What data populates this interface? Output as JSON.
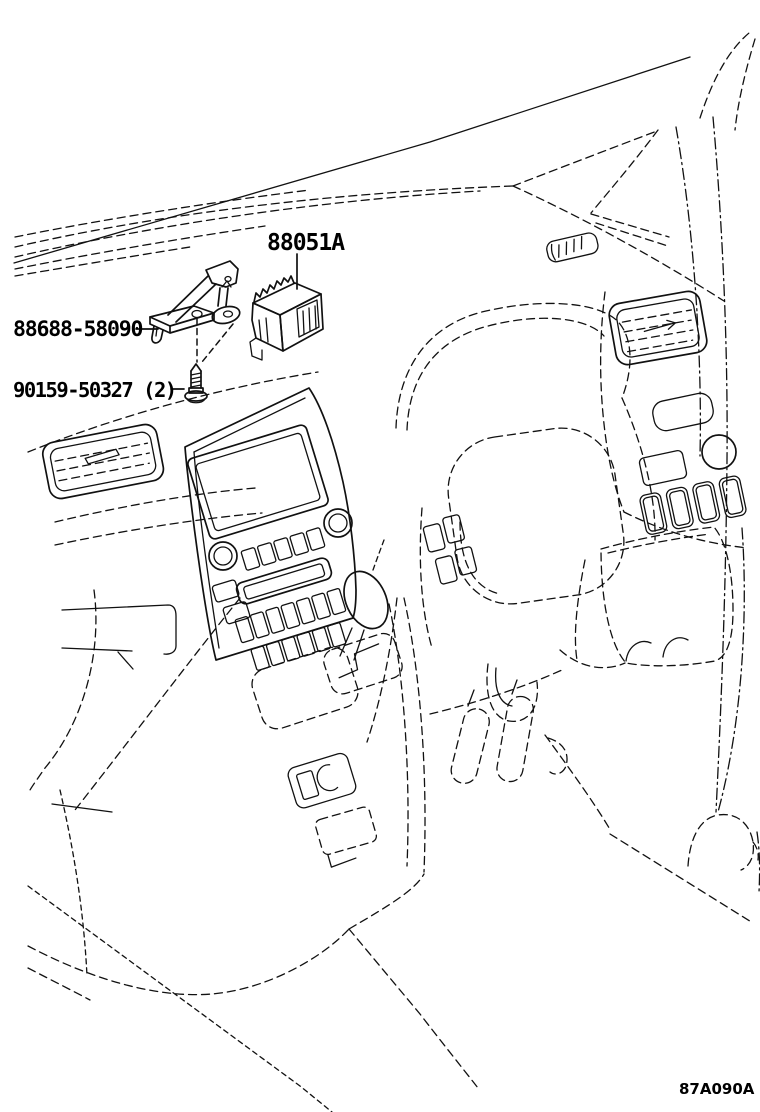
{
  "diagram": {
    "figure_code": "87A090A",
    "callouts": [
      {
        "id": "ecu-module",
        "label": "88051A"
      },
      {
        "id": "mounting-bracket",
        "label": "88688-58090"
      },
      {
        "id": "screw",
        "label": "90159-50327 (2)"
      }
    ],
    "colors": {
      "line": "#111111",
      "background": "#ffffff"
    }
  }
}
